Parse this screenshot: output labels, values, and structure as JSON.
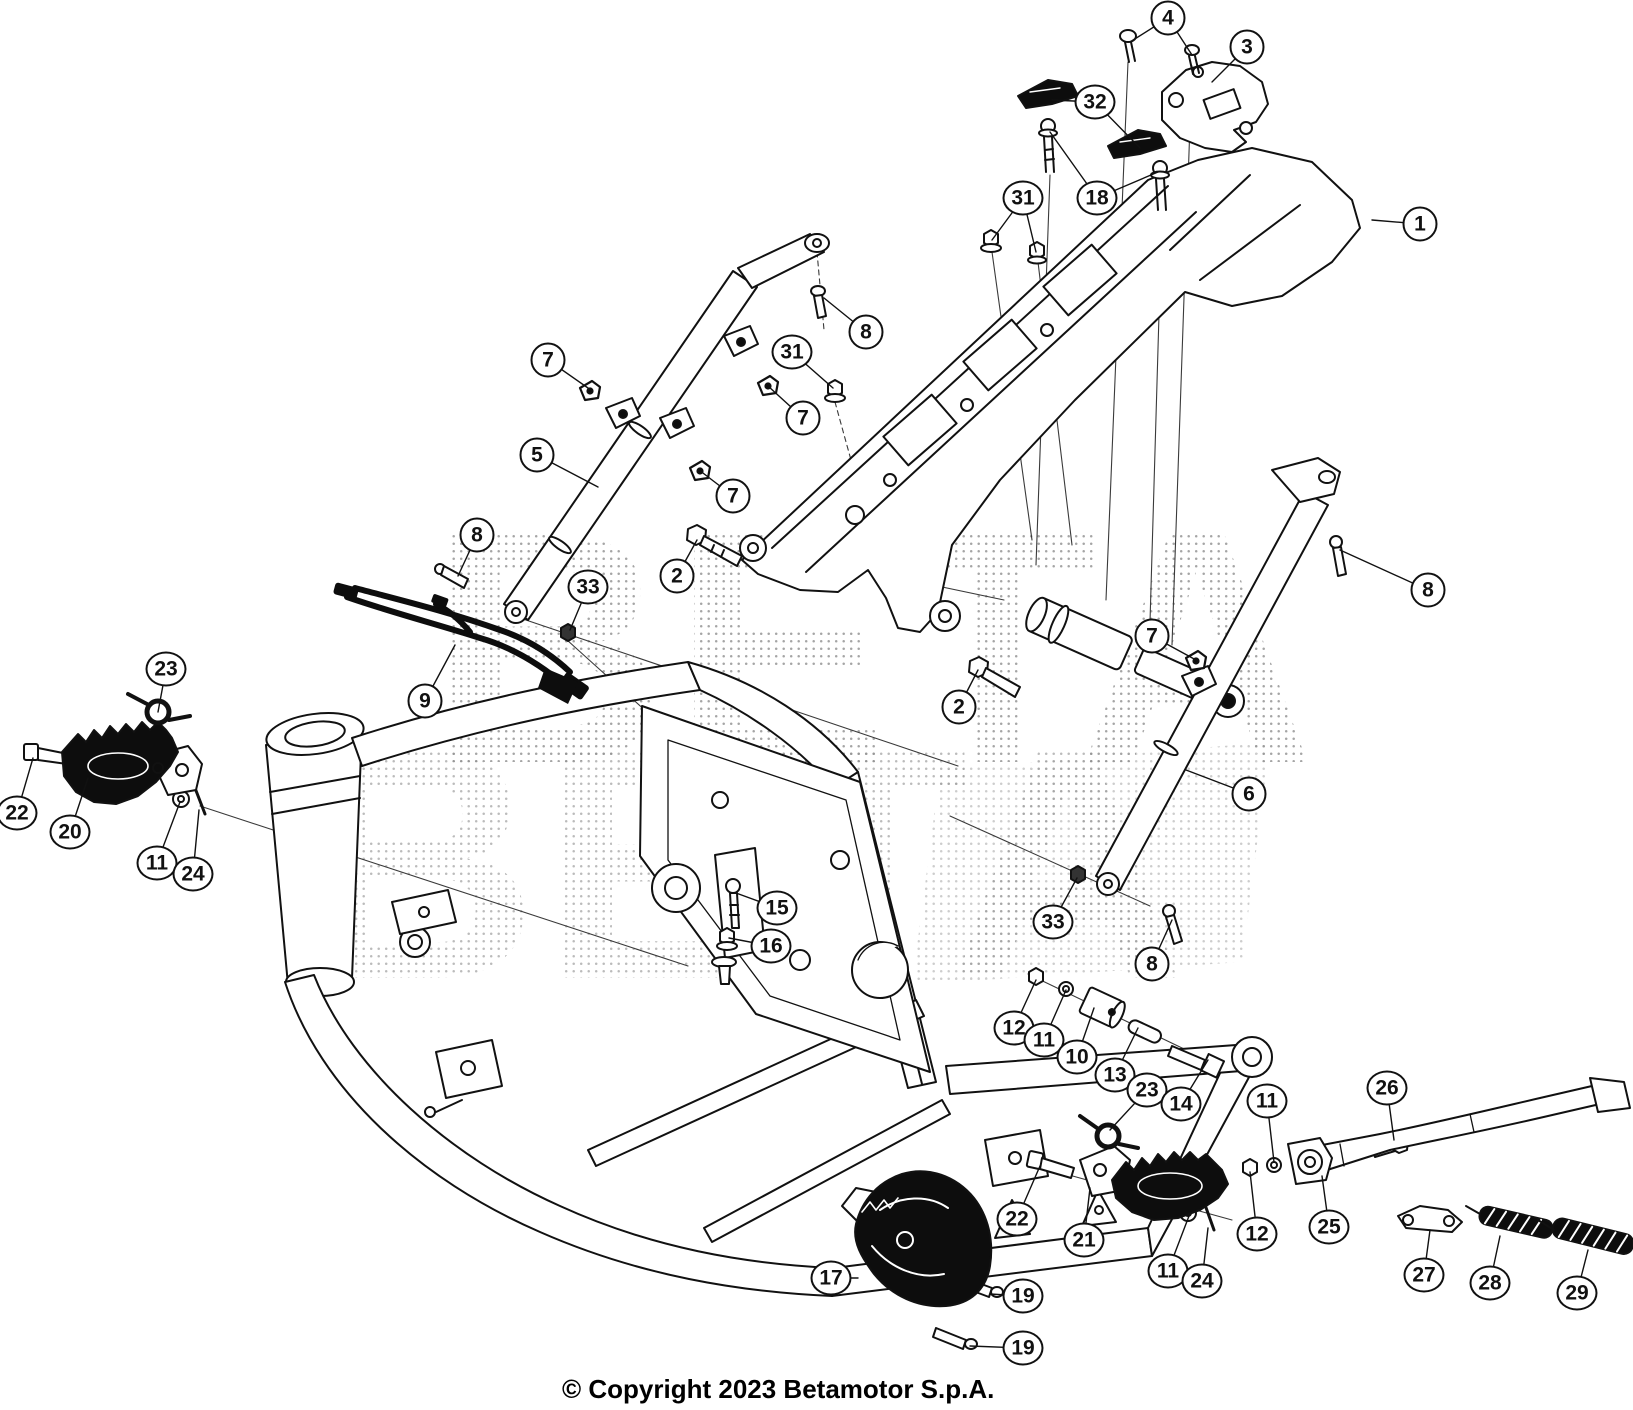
{
  "image": {
    "width": 1633,
    "height": 1410,
    "type": "exploded-parts-diagram",
    "subject": "motorcycle frame, rear subframe, footrests and side stand"
  },
  "colors": {
    "background": "#ffffff",
    "line": "#111111",
    "thin_line": "#3a3a3a",
    "dark_part": "#0d0d0d",
    "watermark_dot": "#8f8f8f",
    "callout_fill": "#ffffff",
    "callout_border": "#111111",
    "text": "#000000"
  },
  "watermark": {
    "text": "BETA"
  },
  "footer": {
    "copyright": "© Copyright 2023 Betamotor S.p.A."
  },
  "part_numbers_visible": [
    "1",
    "2",
    "3",
    "4",
    "5",
    "6",
    "7",
    "8",
    "9",
    "10",
    "11",
    "12",
    "13",
    "14",
    "15",
    "16",
    "17",
    "18",
    "19",
    "20",
    "21",
    "22",
    "23",
    "24",
    "25",
    "26",
    "27",
    "28",
    "29",
    "31",
    "32",
    "33"
  ],
  "callouts": [
    {
      "label": "4",
      "x": 1168,
      "y": 18,
      "leaders": [
        [
          1130,
          42
        ],
        [
          1192,
          55
        ]
      ]
    },
    {
      "label": "3",
      "x": 1247,
      "y": 47,
      "leaders": [
        [
          1212,
          82
        ]
      ]
    },
    {
      "label": "32",
      "x": 1095,
      "y": 102,
      "leaders": [
        [
          1052,
          100
        ],
        [
          1140,
          148
        ]
      ]
    },
    {
      "label": "18",
      "x": 1097,
      "y": 198,
      "leaders": [
        [
          1050,
          132
        ],
        [
          1158,
          172
        ]
      ]
    },
    {
      "label": "31",
      "x": 1023,
      "y": 198,
      "leaders": [
        [
          992,
          240
        ],
        [
          1036,
          252
        ]
      ]
    },
    {
      "label": "1",
      "x": 1420,
      "y": 224,
      "leaders": [
        [
          1372,
          220
        ]
      ]
    },
    {
      "label": "8",
      "x": 866,
      "y": 332,
      "leaders": [
        [
          824,
          298
        ]
      ]
    },
    {
      "label": "31",
      "x": 792,
      "y": 352,
      "leaders": [
        [
          833,
          388
        ]
      ]
    },
    {
      "label": "7",
      "x": 548,
      "y": 360,
      "leaders": [
        [
          588,
          388
        ]
      ]
    },
    {
      "label": "7",
      "x": 803,
      "y": 418,
      "leaders": [
        [
          768,
          386
        ]
      ]
    },
    {
      "label": "5",
      "x": 537,
      "y": 455,
      "leaders": [
        [
          598,
          487
        ]
      ]
    },
    {
      "label": "7",
      "x": 733,
      "y": 496,
      "leaders": [
        [
          699,
          470
        ]
      ]
    },
    {
      "label": "8",
      "x": 477,
      "y": 535,
      "leaders": [
        [
          458,
          576
        ]
      ]
    },
    {
      "label": "2",
      "x": 677,
      "y": 576,
      "leaders": [
        [
          697,
          540
        ]
      ]
    },
    {
      "label": "33",
      "x": 588,
      "y": 587,
      "leaders": [
        [
          570,
          630
        ]
      ]
    },
    {
      "label": "8",
      "x": 1428,
      "y": 590,
      "leaders": [
        [
          1340,
          550
        ]
      ]
    },
    {
      "label": "7",
      "x": 1152,
      "y": 636,
      "leaders": [
        [
          1196,
          660
        ]
      ]
    },
    {
      "label": "23",
      "x": 166,
      "y": 669,
      "leaders": [
        [
          158,
          712
        ]
      ]
    },
    {
      "label": "9",
      "x": 425,
      "y": 701,
      "leaders": [
        [
          455,
          645
        ]
      ]
    },
    {
      "label": "2",
      "x": 959,
      "y": 707,
      "leaders": [
        [
          978,
          670
        ]
      ]
    },
    {
      "label": "6",
      "x": 1249,
      "y": 794,
      "leaders": [
        [
          1186,
          770
        ]
      ]
    },
    {
      "label": "22",
      "x": 17,
      "y": 813,
      "leaders": [
        [
          33,
          758
        ]
      ]
    },
    {
      "label": "20",
      "x": 70,
      "y": 832,
      "leaders": [
        [
          88,
          778
        ]
      ]
    },
    {
      "label": "11",
      "x": 157,
      "y": 863,
      "leaders": [
        [
          180,
          802
        ]
      ]
    },
    {
      "label": "24",
      "x": 193,
      "y": 874,
      "leaders": [
        [
          199,
          810
        ]
      ]
    },
    {
      "label": "15",
      "x": 777,
      "y": 908,
      "leaders": [
        [
          736,
          893
        ]
      ]
    },
    {
      "label": "33",
      "x": 1053,
      "y": 922,
      "leaders": [
        [
          1077,
          878
        ]
      ]
    },
    {
      "label": "16",
      "x": 771,
      "y": 946,
      "leaders": [
        [
          729,
          938
        ]
      ]
    },
    {
      "label": "8",
      "x": 1152,
      "y": 964,
      "leaders": [
        [
          1172,
          920
        ]
      ]
    },
    {
      "label": "12",
      "x": 1014,
      "y": 1028,
      "leaders": [
        [
          1036,
          980
        ]
      ]
    },
    {
      "label": "11",
      "x": 1044,
      "y": 1040,
      "leaders": [
        [
          1066,
          990
        ]
      ]
    },
    {
      "label": "10",
      "x": 1077,
      "y": 1057,
      "leaders": [
        [
          1094,
          1008
        ]
      ]
    },
    {
      "label": "13",
      "x": 1115,
      "y": 1075,
      "leaders": [
        [
          1138,
          1028
        ]
      ]
    },
    {
      "label": "23",
      "x": 1147,
      "y": 1090,
      "leaders": [
        [
          1110,
          1130
        ]
      ]
    },
    {
      "label": "26",
      "x": 1387,
      "y": 1088,
      "leaders": [
        [
          1394,
          1140
        ]
      ]
    },
    {
      "label": "11",
      "x": 1267,
      "y": 1101,
      "leaders": [
        [
          1274,
          1162
        ]
      ]
    },
    {
      "label": "14",
      "x": 1181,
      "y": 1104,
      "leaders": [
        [
          1208,
          1060
        ]
      ]
    },
    {
      "label": "22",
      "x": 1017,
      "y": 1219,
      "leaders": [
        [
          1040,
          1166
        ]
      ]
    },
    {
      "label": "21",
      "x": 1084,
      "y": 1240,
      "leaders": [
        [
          1090,
          1188
        ]
      ]
    },
    {
      "label": "12",
      "x": 1257,
      "y": 1234,
      "leaders": [
        [
          1250,
          1172
        ]
      ]
    },
    {
      "label": "25",
      "x": 1329,
      "y": 1227,
      "leaders": [
        [
          1322,
          1176
        ]
      ]
    },
    {
      "label": "11",
      "x": 1168,
      "y": 1271,
      "leaders": [
        [
          1189,
          1216
        ]
      ]
    },
    {
      "label": "24",
      "x": 1202,
      "y": 1281,
      "leaders": [
        [
          1208,
          1228
        ]
      ]
    },
    {
      "label": "27",
      "x": 1424,
      "y": 1275,
      "leaders": [
        [
          1430,
          1230
        ]
      ]
    },
    {
      "label": "28",
      "x": 1490,
      "y": 1283,
      "leaders": [
        [
          1500,
          1236
        ]
      ]
    },
    {
      "label": "29",
      "x": 1577,
      "y": 1293,
      "leaders": [
        [
          1588,
          1250
        ]
      ]
    },
    {
      "label": "17",
      "x": 831,
      "y": 1278,
      "leaders": [
        [
          858,
          1278
        ]
      ]
    },
    {
      "label": "19",
      "x": 1023,
      "y": 1296,
      "leaders": [
        [
          990,
          1294
        ]
      ]
    },
    {
      "label": "19",
      "x": 1023,
      "y": 1348,
      "leaders": [
        [
          970,
          1346
        ]
      ]
    }
  ]
}
